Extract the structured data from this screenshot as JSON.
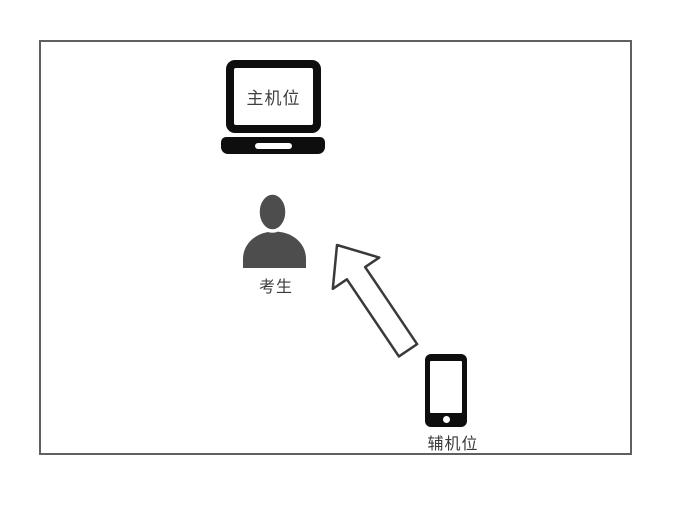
{
  "diagram": {
    "labels": {
      "main_camera": "主机位",
      "examinee": "考生",
      "aux_camera": "辅机位"
    },
    "icons": {
      "laptop": "laptop-icon",
      "person": "person-icon",
      "phone": "phone-icon",
      "arrow": "arrow-up-left-icon"
    },
    "colors": {
      "background": "#ffffff",
      "frame_border": "#606060",
      "device_black": "#0e0e0e",
      "person_gray": "#4d4d4d",
      "label_text": "#3a3a3a",
      "arrow_stroke": "#3a3a3a",
      "arrow_fill": "#ffffff"
    }
  }
}
